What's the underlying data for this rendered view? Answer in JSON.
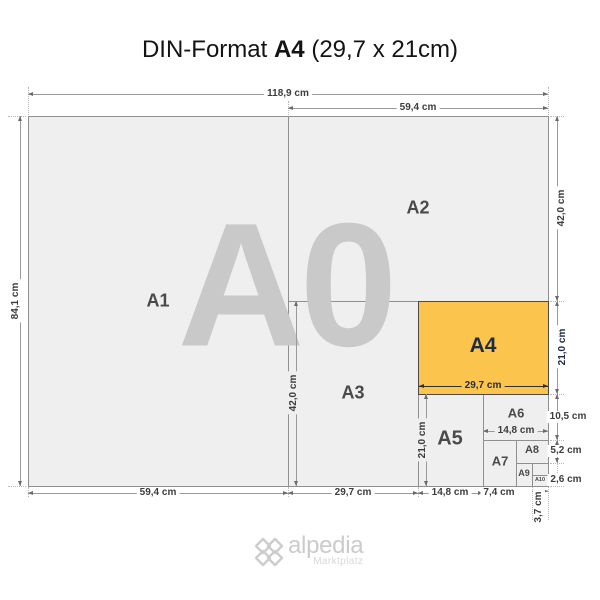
{
  "title": {
    "prefix": "DIN-Format",
    "bold": "A4",
    "suffix": " (29,7 x 21cm)"
  },
  "watermark": "A0",
  "format_labels": {
    "a1": "A1",
    "a2": "A2",
    "a3": "A3",
    "a4": "A4",
    "a5": "A5",
    "a6": "A6",
    "a7": "A7",
    "a8": "A8",
    "a9": "A9",
    "a10": "A10"
  },
  "dims": {
    "a0_width": "118,9 cm",
    "a0_height": "84,1 cm",
    "top_a1_width": "59,4 cm",
    "right_a2_height": "42,0 cm",
    "right_a4_height": "21,0 cm",
    "right_a6_height": "10,5 cm",
    "right_a8_height": "5,2 cm",
    "right_a10_height": "2,6 cm",
    "bottom_a1_width": "59,4 cm",
    "bottom_a3_width": "29,7 cm",
    "bottom_a5_width": "14,8 cm",
    "bottom_a7_width": "7,4 cm",
    "bottom_a10_width": "3,7 cm",
    "inner_a3_height": "42,0 cm",
    "inner_a5_height": "21,0 cm",
    "inner_a4_width": "29,7 cm",
    "inner_a6_width": "14,8 cm"
  },
  "logo": {
    "name": "alpedia",
    "tagline": "Marktplatz"
  },
  "colors": {
    "highlight_fill": "#FBC54D",
    "highlight_text": "#1F2A44",
    "paper_fill": "#EFEFEF",
    "border_line": "#8F8F8F",
    "watermark": "#C9C9C9",
    "dim_text": "#3D3D3D",
    "format_label_text": "#4A4A4A",
    "logo_text": "#CBCBCB"
  }
}
